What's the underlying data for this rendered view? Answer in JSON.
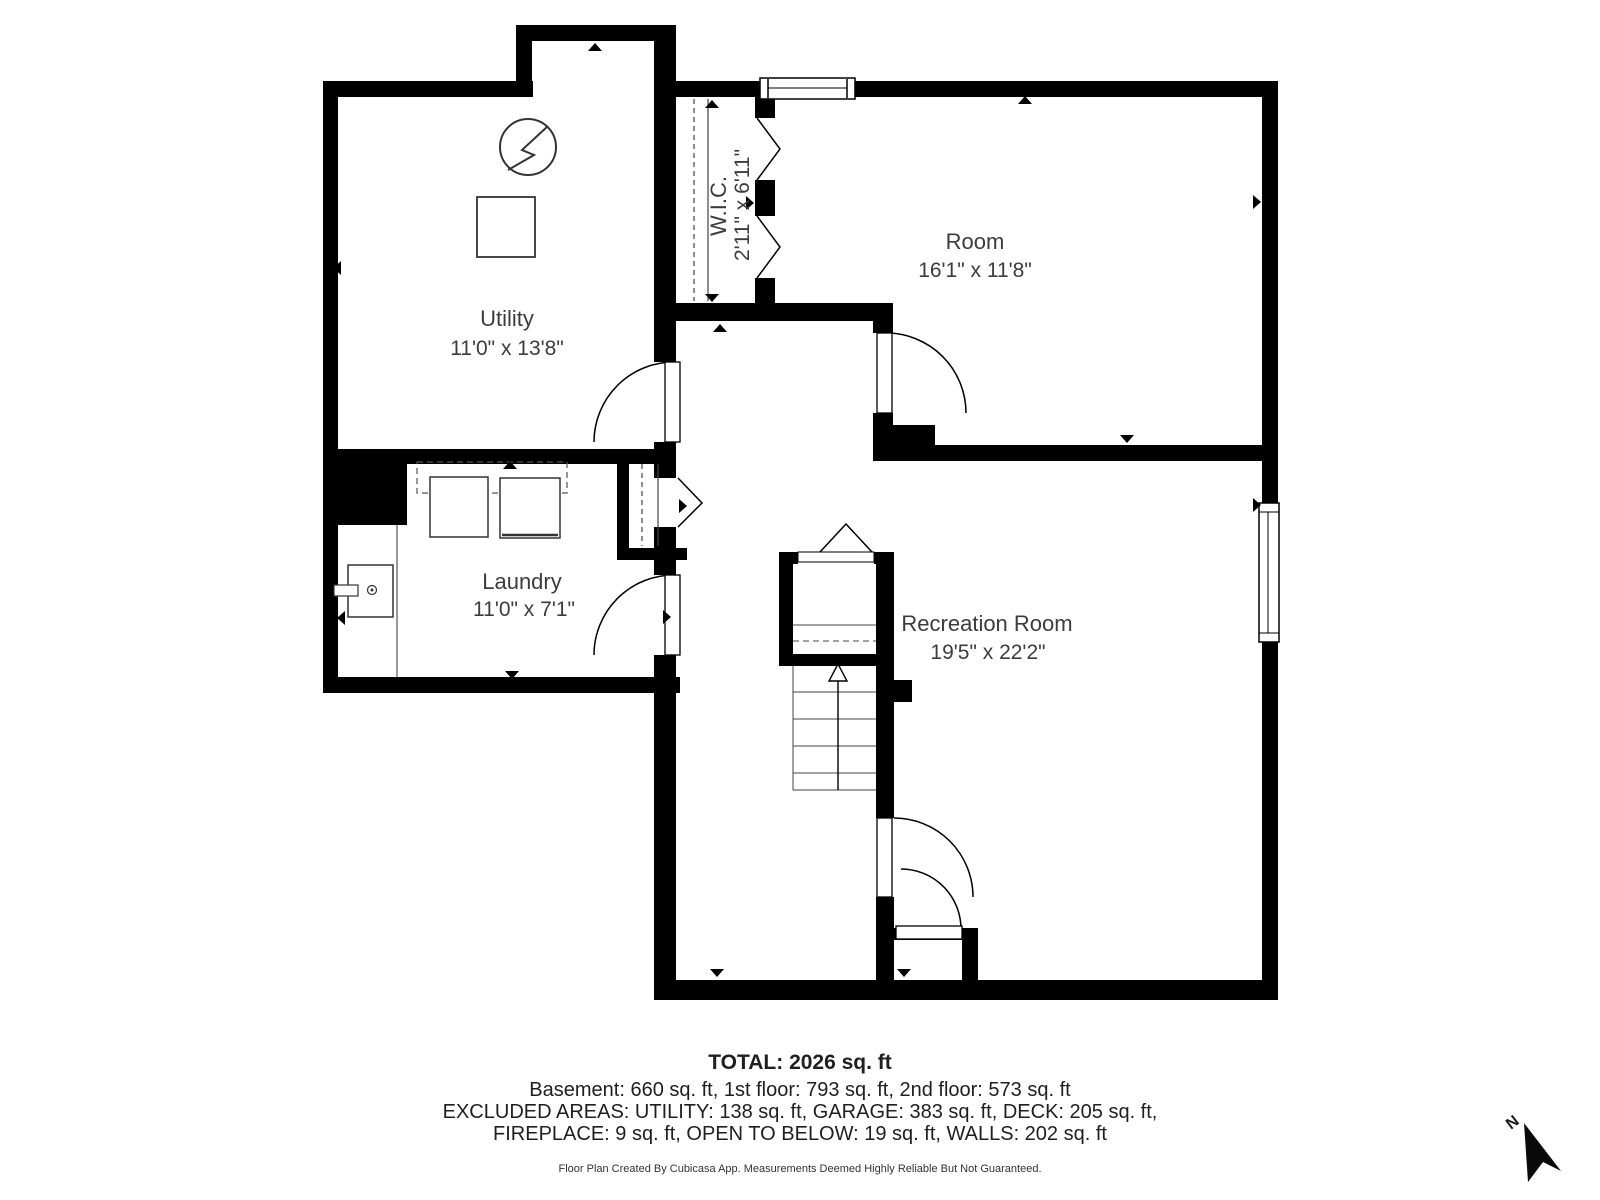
{
  "plan": {
    "rooms": [
      {
        "name": "Utility",
        "dims": "11'0\" x 13'8\""
      },
      {
        "name": "W.I.C.",
        "dims": "2'11\" x 6'11\""
      },
      {
        "name": "Room",
        "dims": "16'1\" x 11'8\""
      },
      {
        "name": "Laundry",
        "dims": "11'0\" x 7'1\""
      },
      {
        "name": "Recreation Room",
        "dims": "19'5\" x 22'2\""
      }
    ],
    "compass_label": "N"
  },
  "summary": {
    "total": "TOTAL: 2026 sq. ft",
    "floors": "Basement: 660 sq. ft, 1st floor: 793 sq. ft, 2nd floor: 573 sq. ft",
    "excluded_line1": "EXCLUDED AREAS: UTILITY: 138 sq. ft, GARAGE: 383 sq. ft, DECK: 205 sq. ft,",
    "excluded_line2": "FIREPLACE: 9 sq. ft, OPEN TO BELOW: 19 sq. ft, WALLS: 202 sq. ft",
    "disclaimer": "Floor Plan Created By Cubicasa App. Measurements Deemed Highly Reliable But Not Guaranteed."
  },
  "colors": {
    "wall": "#000000",
    "label": "#3c3c3c",
    "summary_text": "#1f1f1f"
  }
}
